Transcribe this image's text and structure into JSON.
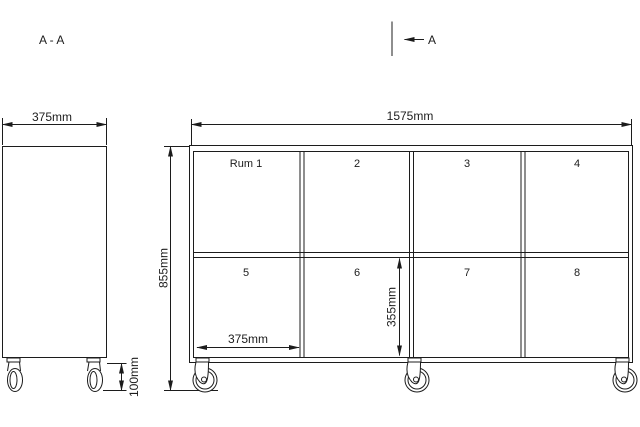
{
  "drawing": {
    "section_title": "A - A",
    "section_cut": {
      "label": "A"
    },
    "side_view": {
      "depth_dim": "375mm",
      "caster_height_dim": "100mm"
    },
    "front_view": {
      "width_dim": "1575mm",
      "height_dim": "855mm",
      "compartment_width_dim": "375mm",
      "compartment_height_dim": "355mm",
      "compartments_top": [
        "Rum 1",
        "2",
        "3",
        "4"
      ],
      "compartments_bottom": [
        "5",
        "6",
        "7",
        "8"
      ]
    },
    "colors": {
      "line": "#1c1c1c",
      "background": "#ffffff"
    }
  }
}
